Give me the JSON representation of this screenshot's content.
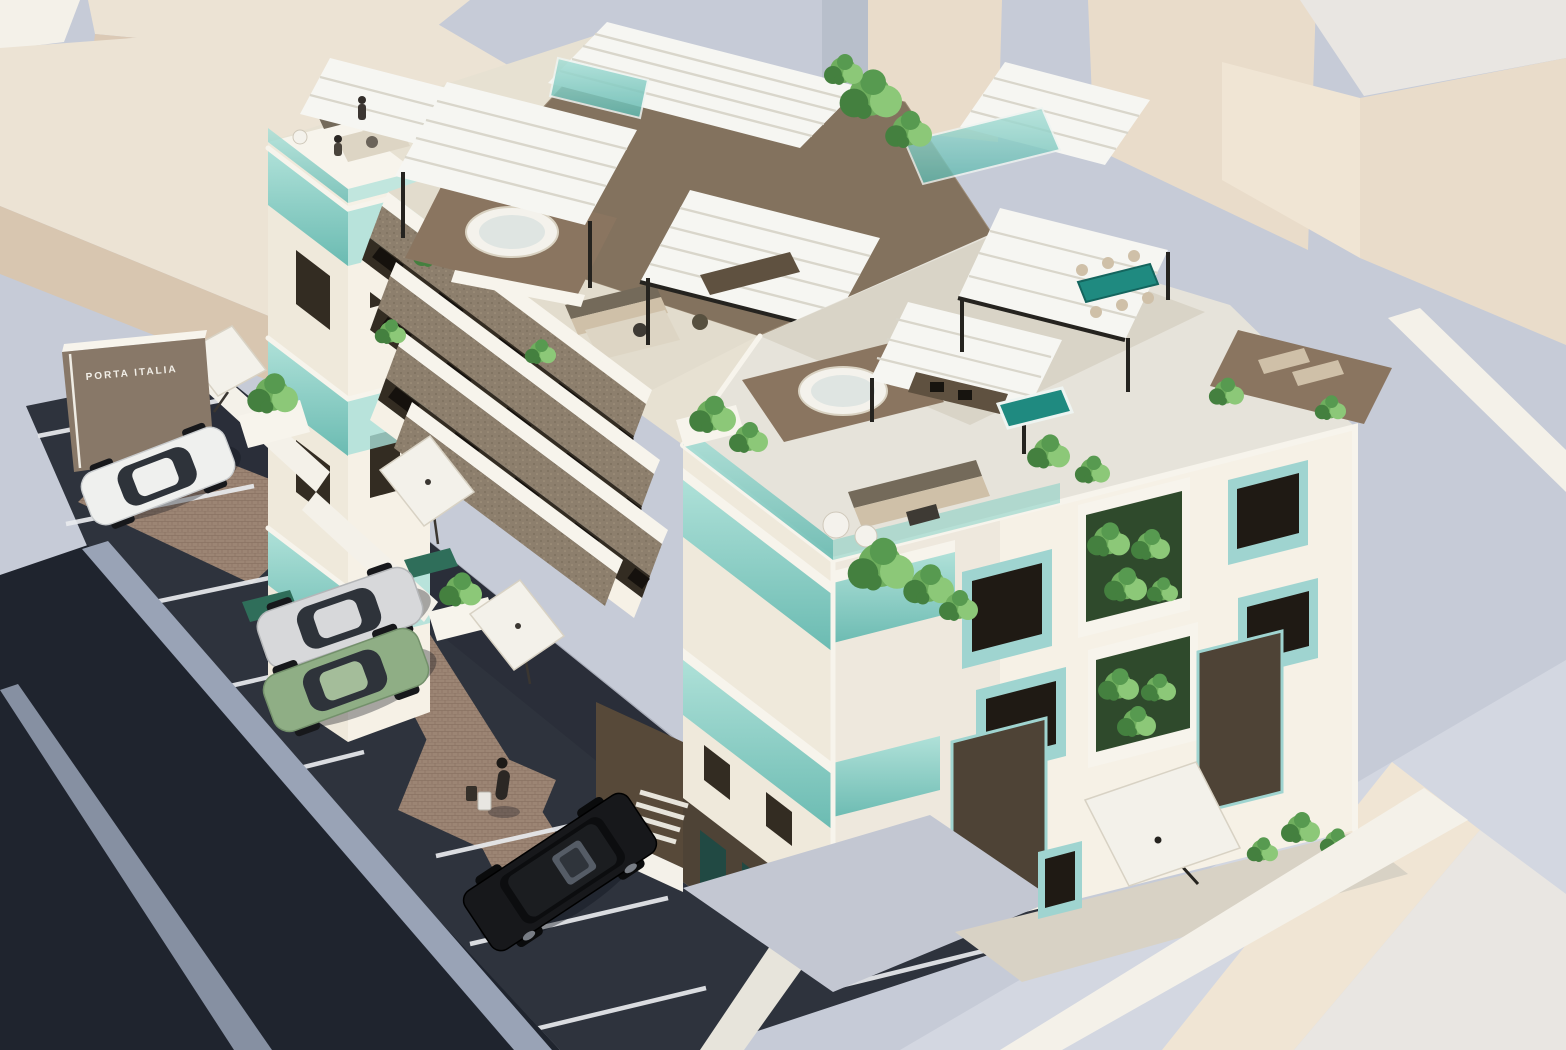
{
  "meta": {
    "kind": "3d-architectural-render",
    "view": "aerial axonometric",
    "subject": "modern three-storey residential complex with rooftop terraces"
  },
  "signage": {
    "board_text": "PORTA ITALIA"
  },
  "site": {
    "street": "dark asphalt road along south-west edge with light curb bands",
    "parking": {
      "surface": "dark asphalt with white stall lines",
      "vehicles": [
        {
          "name": "white-coupe",
          "color": "#eff0ee"
        },
        {
          "name": "silver-coupe",
          "color": "#d7d8da"
        },
        {
          "name": "green-coupe",
          "color": "#8fae85"
        },
        {
          "name": "black-suv",
          "color": "#17181b"
        }
      ]
    },
    "people": [
      {
        "name": "pedestrian-with-luggage",
        "location": "brick path by parking"
      },
      {
        "name": "two-residents",
        "location": "left tower roof terrace"
      }
    ],
    "parasols": 4
  },
  "building": {
    "storeys": 3,
    "facade": "white render, aqua glass balconies, teal window frames, vertical planted niches",
    "roof": "taupe flat roofs, white louvre pergolas on black posts",
    "amenities": [
      "round jacuzzi decks (2)",
      "teal dining table under pergola",
      "teal plunge pool with outdoor kitchen",
      "outdoor lounge sofas",
      "sun lounger deck",
      "cantilever parasols",
      "terraced planted balconies"
    ]
  },
  "palette": {
    "ground": "#c6cbd7",
    "ground-light": "#d3d7e1",
    "beige-top": "#ece3d4",
    "beige-side": "#dbc9b5",
    "beige-front-a": "#d8c6b0",
    "beige-front-b": "#cfbda6",
    "warm-front": "#e9dcca",
    "pale-top": "#e9e6e2",
    "step-face": "#f0e5d4",
    "block-gray": "#b8bfcb",
    "white-wall": "#f4f1e9",
    "rear-mass": "#e7e1d2",
    "roof-brown": "#83725e",
    "concrete": "#e6e3da",
    "parapet-band": "#d9d4c7",
    "white-build": "#f6f1e6",
    "white-build-dim": "#efe9db",
    "white-cap": "#f7f4ec",
    "floor-light": "#e2dccd",
    "glass-teal": "#84cfc5",
    "glass-teal-light": "#a9e0d8",
    "glass-teal-deep": "#5fb7ae",
    "teal-accent": "#1f8a80",
    "teal-frame": "#9fd4d0",
    "slot-dark": "#332c22",
    "window-dark": "#1f1a14",
    "dark-base": "#4e4336",
    "entry-brown": "#574939",
    "kitchen-brown": "#5f5140",
    "deck-brown": "#8a7560",
    "wall-taupe": "#8d7f6d",
    "road": "#1f242e",
    "asphalt": "#2e333d",
    "curb": "#99a3b6",
    "line-white": "#e9ebee",
    "walk": "#e7e4db",
    "apron": "#c3c7d2",
    "patio": "#d8d2c5",
    "pergola": "#f6f6f2",
    "stripe": "#d9d6cb",
    "frame-black": "#25231f",
    "plant-light": "#8cc878",
    "plant-mid": "#6fae5e",
    "plant-mid2": "#579a50",
    "plant-dark": "#44803f",
    "umbrella": "#f3f1ea",
    "umbrella-edge": "#d8d2c4",
    "sofa-dark": "#746a5a",
    "cushion-tan": "#cfc0a8",
    "rug": "#ddd5c4",
    "sign-brown": "#887868",
    "sign-text": "#f2efe8",
    "person-dark": "#2b2724",
    "car-white": "#eff0ee",
    "car-silver": "#d7d8da",
    "car-green": "#8fae85",
    "car-black": "#17181b",
    "car-glass": "#2e333a",
    "jacuzzi-rim": "#f4f2ec",
    "jacuzzi-water": "#dfe5e2"
  }
}
